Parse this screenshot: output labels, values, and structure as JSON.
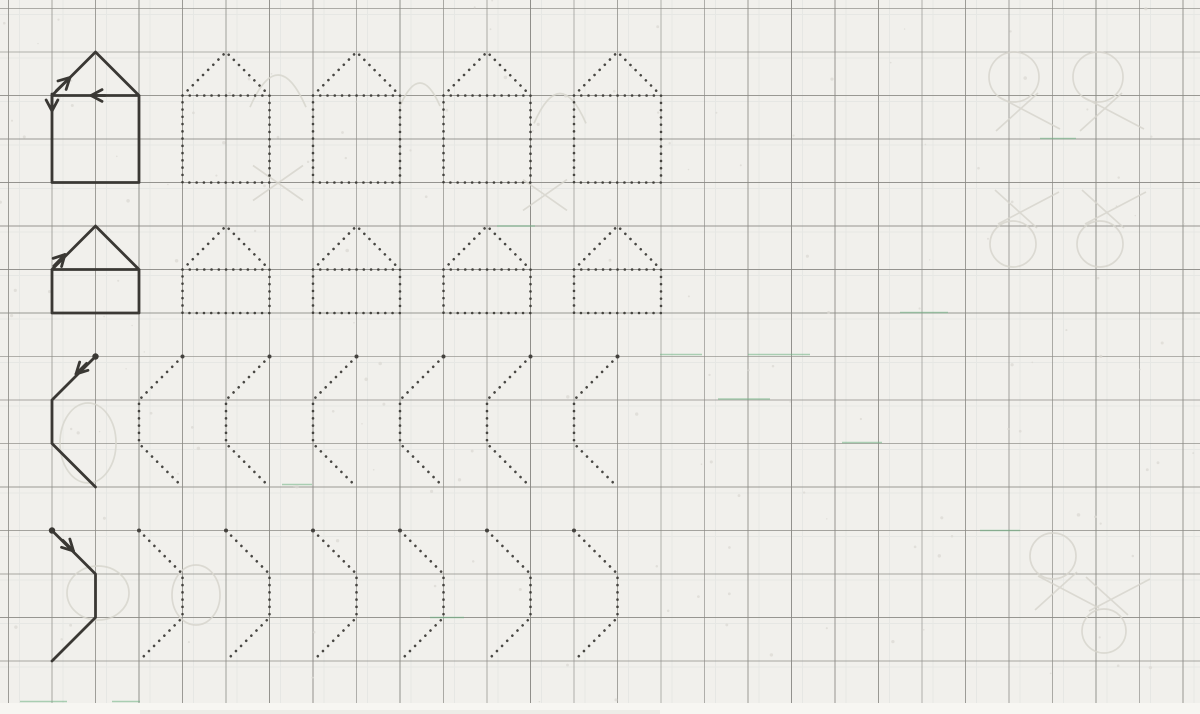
{
  "document": {
    "kind": "scanned tracing worksheet",
    "paper": "squared exercise-book page",
    "content_summary": "Model strokes (house shapes and zigzag strokes) with direction arrows on the left, dotted outlines to trace on the right"
  },
  "canvas": {
    "width": 1200,
    "height": 714
  },
  "palette": {
    "paper": "#f1f0ec",
    "paper_edge": "#f7f6f2",
    "grid_line": "#8b8a85",
    "ghost_grid": "#aebcbc",
    "grid_green": "#6fb483",
    "ink": "#3a3834",
    "ghost": "#d6d4cc",
    "speckle": "#dbd9d3"
  },
  "grid": {
    "origin_x": 8.5,
    "origin_y": 8.5,
    "cell": 43.5,
    "v_lines": 28,
    "h_lines": 17
  },
  "stroke_width": 2.8,
  "dot_style": {
    "dot_gap": 7.25,
    "dot_size": 2.6
  },
  "rows": [
    {
      "id": "row-1-big-house",
      "pattern": "house",
      "desc": "two-cell square house with one-cell roof, solid model then 4 dotted copies",
      "solid_x": 52,
      "dotted_x": [
        182.5,
        313,
        443.5,
        574
      ],
      "geom": {
        "width": 87,
        "roof_top_y": 52,
        "eave_y": 95.5,
        "base_y": 182.5
      },
      "start_dot": false,
      "arrows": [
        {
          "x": 70,
          "y": 77.5,
          "angle": -44,
          "tail": 19
        },
        {
          "x": 91,
          "y": 95.5,
          "angle": 180,
          "tail": 14
        },
        {
          "x": 52,
          "y": 111,
          "angle": 90,
          "tail": 17
        }
      ]
    },
    {
      "id": "row-2-low-house",
      "pattern": "house",
      "desc": "two-cell by one-cell house with roof, solid model then 4 dotted copies",
      "solid_x": 52,
      "dotted_x": [
        182.5,
        313,
        443.5,
        574
      ],
      "geom": {
        "width": 87,
        "roof_top_y": 226,
        "eave_y": 269.5,
        "base_y": 313
      },
      "start_dot": false,
      "arrows": [
        {
          "x": 65,
          "y": 254.5,
          "angle": -46,
          "tail": 16
        }
      ]
    },
    {
      "id": "row-3-zigzag-left",
      "pattern": "zigzag",
      "desc": "stroke: down-left diagonal, vertical, down-right diagonal; solid model then 6 dotted copies",
      "solid_x": 95.5,
      "dotted_x": [
        182.5,
        269.5,
        356.5,
        443.5,
        530.5,
        617.5
      ],
      "geom": {
        "y_top": 356.5,
        "y_mid1": 400,
        "y_mid2": 443.5,
        "y_bot": 487,
        "dx": -43.5
      },
      "start_dot": true,
      "arrows": [
        {
          "x": 76,
          "y": 374,
          "angle": 135,
          "tail": 15
        }
      ]
    },
    {
      "id": "row-4-zigzag-right",
      "pattern": "zigzag",
      "desc": "stroke: down-right diagonal, vertical, down-left diagonal; solid model then 6 dotted copies",
      "solid_x": 52,
      "dotted_x": [
        139,
        226,
        313,
        400,
        487,
        574
      ],
      "geom": {
        "y_top": 530.5,
        "y_mid1": 574,
        "y_mid2": 617.5,
        "y_bot": 661,
        "dx": 43.5
      },
      "start_dot": true,
      "arrows": [
        {
          "x": 73.5,
          "y": 551,
          "angle": 45,
          "tail": 15
        }
      ]
    }
  ],
  "ghosts": [
    {
      "type": "balloon",
      "cx": 1014,
      "cy": 77,
      "r": 25,
      "dir": 1
    },
    {
      "type": "balloon",
      "cx": 1098,
      "cy": 77,
      "r": 25,
      "dir": 1
    },
    {
      "type": "balloon",
      "cx": 1013,
      "cy": 244,
      "r": 23,
      "dir": -1
    },
    {
      "type": "balloon",
      "cx": 1100,
      "cy": 244,
      "r": 23,
      "dir": -1
    },
    {
      "type": "balloon",
      "cx": 1053,
      "cy": 556,
      "r": 23,
      "dir": 1
    },
    {
      "type": "balloon",
      "cx": 1104,
      "cy": 631,
      "r": 22,
      "dir": -1
    },
    {
      "type": "ellipse",
      "cx": 88,
      "cy": 443,
      "rx": 28,
      "ry": 40
    },
    {
      "type": "ellipse",
      "cx": 98,
      "cy": 593,
      "rx": 31,
      "ry": 27
    },
    {
      "type": "ellipse",
      "cx": 196,
      "cy": 595,
      "rx": 24,
      "ry": 30
    },
    {
      "type": "arc",
      "cx": 278,
      "cy": 82,
      "r": 28
    },
    {
      "type": "arc",
      "cx": 420,
      "cy": 88,
      "r": 20
    },
    {
      "type": "arc",
      "cx": 560,
      "cy": 100,
      "r": 26
    },
    {
      "type": "cross",
      "cx": 278,
      "cy": 183,
      "r": 25
    },
    {
      "type": "cross",
      "cx": 545,
      "cy": 195,
      "r": 22
    }
  ],
  "green_marks": [
    {
      "x": 660,
      "y": 354.5,
      "w": 42
    },
    {
      "x": 748,
      "y": 354.5,
      "w": 62
    },
    {
      "x": 718,
      "y": 399,
      "w": 52
    },
    {
      "x": 842,
      "y": 442.5,
      "w": 40
    },
    {
      "x": 282,
      "y": 484.5,
      "w": 30
    },
    {
      "x": 20,
      "y": 701.5,
      "w": 47
    },
    {
      "x": 112,
      "y": 701.5,
      "w": 28
    },
    {
      "x": 497,
      "y": 226,
      "w": 38
    },
    {
      "x": 900,
      "y": 312.5,
      "w": 48
    },
    {
      "x": 1040,
      "y": 138.5,
      "w": 36
    },
    {
      "x": 430,
      "y": 617.5,
      "w": 34
    },
    {
      "x": 980,
      "y": 530.5,
      "w": 40
    }
  ],
  "speckle_count": 160
}
